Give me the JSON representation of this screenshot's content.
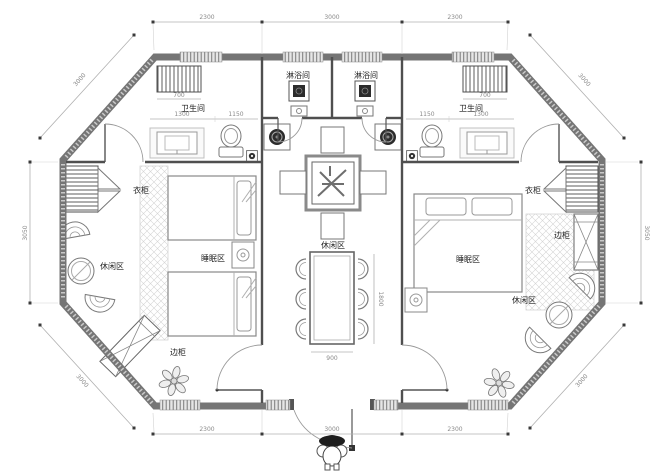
{
  "labels": {
    "bathroom_left": "卫生间",
    "bathroom_right": "卫生间",
    "shower_left": "淋浴间",
    "shower_right": "淋浴间",
    "wardrobe_left": "衣柜",
    "wardrobe_right": "衣柜",
    "sleep_left": "睡眠区",
    "sleep_right": "睡眠区",
    "lounge_left": "休闲区",
    "lounge_center": "休闲区",
    "lounge_right": "休闲区",
    "cabinet_left": "边柜",
    "cabinet_right": "边柜"
  },
  "dims": {
    "top_left": "2300",
    "top_mid": "3000",
    "top_right": "2300",
    "bottom_left": "2300",
    "bottom_mid": "3000",
    "bottom_right": "2300",
    "side_left": "3050",
    "side_right": "3050",
    "diag_tl": "3000",
    "diag_tr": "3000",
    "diag_bl": "3000",
    "diag_br": "3000",
    "rad_left": "700",
    "rad_right": "700",
    "bath_left_a": "1300",
    "bath_left_b": "1150",
    "bath_right_a": "1150",
    "bath_right_b": "1300",
    "dining_w": "900",
    "dining_h": "1800"
  },
  "colors": {
    "wall": "#757575",
    "partition": "#4f4f4f",
    "dimension": "#8a8a8a",
    "hatch": "#d4d4d4",
    "fixture_dark": "#2c2c2c",
    "background": "#ffffff"
  }
}
